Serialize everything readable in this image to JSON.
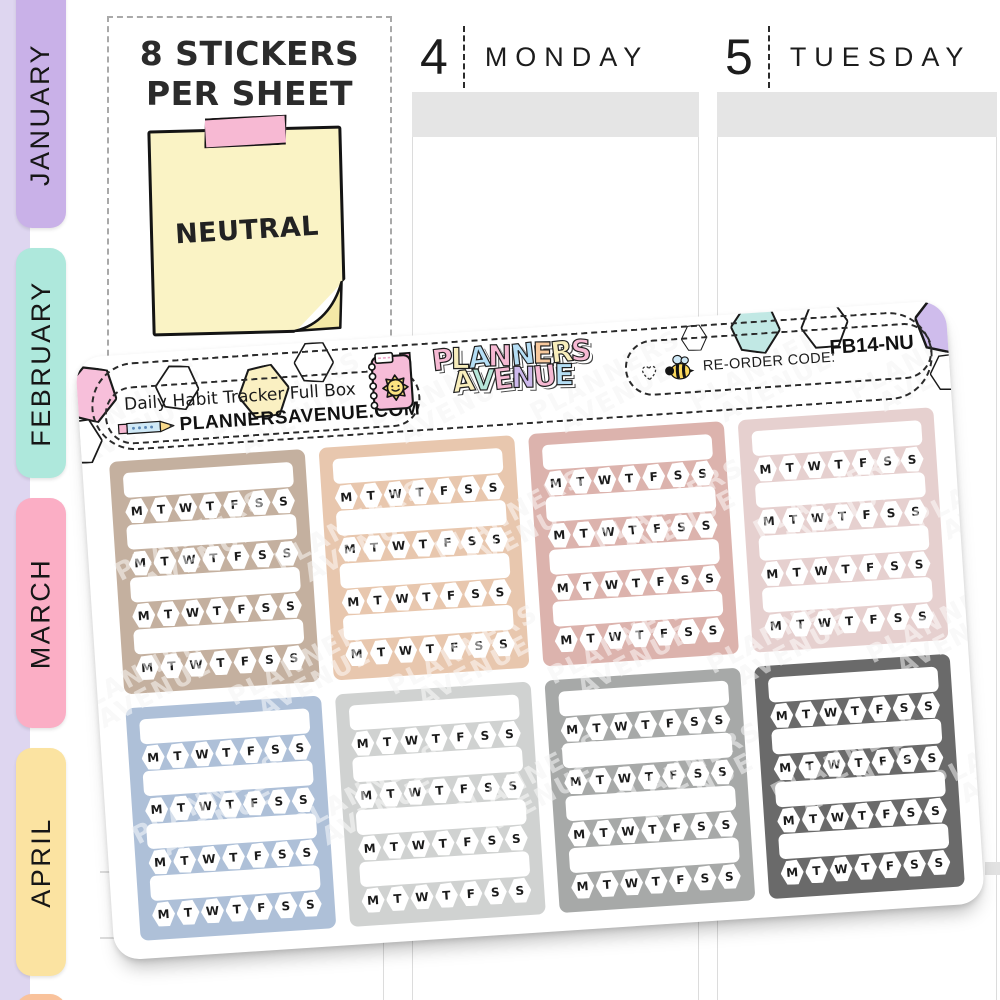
{
  "page": {
    "background": "#ffffff"
  },
  "sidebar": {
    "strip_color": "#ded6f0",
    "tabs": [
      {
        "label": "JANUARY",
        "color": "#c9b1e8"
      },
      {
        "label": "FEBRUARY",
        "color": "#aee8dc"
      },
      {
        "label": "MARCH",
        "color": "#fbaec5"
      },
      {
        "label": "APRIL",
        "color": "#fbe3a1"
      },
      {
        "label": "",
        "color": "#f9c29b"
      }
    ]
  },
  "promo": {
    "heading_line1": "8 STICKERS",
    "heading_line2": "PER SHEET",
    "note_text": "NEUTRAL",
    "note_color": "#faf3c5",
    "tape_color": "#f7b9d3"
  },
  "planner": {
    "header_bar_color": "#e5e5e5",
    "columns": [
      {
        "number": "4",
        "day": "MONDAY"
      },
      {
        "number": "5",
        "day": "TUESDAY"
      }
    ]
  },
  "sheet": {
    "product_label": "Daily Habit Tracker Full Box",
    "website": "PLANNERSAVENUE.COM",
    "brand_lines": [
      {
        "text": "PLANNERS",
        "letter_colors": [
          "#f6b9d3",
          "#f8eebc",
          "#b5def5",
          "#f6b9d3",
          "#b5def5",
          "#f8c99d",
          "#f8eebc",
          "#f6b9d3"
        ]
      },
      {
        "text": "AVENUE",
        "letter_colors": [
          "#f8eebc",
          "#b7e6da",
          "#f6b9d3",
          "#cdb9ec",
          "#f6b9d3",
          "#b5def5"
        ]
      }
    ],
    "reorder_label": "RE-ORDER CODE:",
    "reorder_code": "FB14-NU",
    "watermark_line1": "PLANNERS",
    "watermark_line2": "AVENUE",
    "day_letters": [
      "M",
      "T",
      "W",
      "T",
      "F",
      "S",
      "S"
    ],
    "rows_per_box": 4,
    "boxes": [
      {
        "name": "tan",
        "color": "#c4b09f"
      },
      {
        "name": "peach",
        "color": "#e8c7ae"
      },
      {
        "name": "rose",
        "color": "#dcb3ad"
      },
      {
        "name": "blush",
        "color": "#e6d0cf"
      },
      {
        "name": "slate-blue",
        "color": "#aec0d8"
      },
      {
        "name": "light-gray",
        "color": "#d0d2d1"
      },
      {
        "name": "gray",
        "color": "#a7a9a8"
      },
      {
        "name": "dark-gray",
        "color": "#6a6a6a"
      }
    ],
    "decor_hexagons": [
      {
        "name": "pink",
        "fill": "#f7bfda"
      },
      {
        "name": "outline",
        "fill": "none"
      },
      {
        "name": "outline",
        "fill": "none"
      },
      {
        "name": "yellow",
        "fill": "#faf0c2"
      },
      {
        "name": "outline",
        "fill": "none"
      },
      {
        "name": "outline",
        "fill": "none"
      },
      {
        "name": "teal",
        "fill": "#c1e8e4"
      },
      {
        "name": "outline",
        "fill": "none"
      },
      {
        "name": "purple",
        "fill": "#cfbcec"
      },
      {
        "name": "outline",
        "fill": "none"
      }
    ]
  }
}
